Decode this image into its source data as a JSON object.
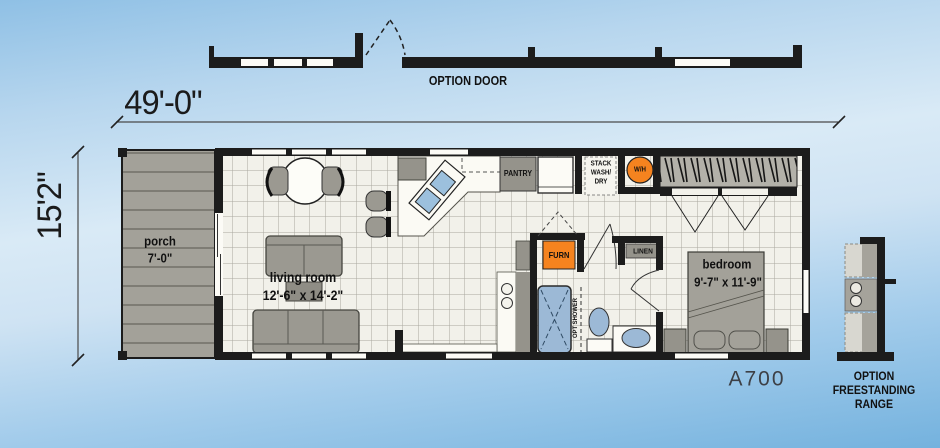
{
  "colors": {
    "wall": "#1c1c1c",
    "tile_floor": "#f2f1ea",
    "porch_deck": "#a3a199",
    "furniture_gray": "#9b9991",
    "cabinet_gray": "#95938b",
    "accent_orange": "#f5831f",
    "fixture_blue": "#9cb9d6",
    "sky_light": "#d9eaf6",
    "sky_dark": "#74b2de"
  },
  "top_elevation": {
    "option_door_label": "OPTION DOOR"
  },
  "dimensions": {
    "overall_width": "49'-0\"",
    "overall_height": "15'2\""
  },
  "rooms": {
    "porch": {
      "name": "porch",
      "size": "7'-0\""
    },
    "living_room": {
      "name": "living room",
      "size": "12'-6\" x 14'-2\""
    },
    "bedroom": {
      "name": "bedroom",
      "size": "9'-7\" x 11'-9\""
    }
  },
  "labels": {
    "pantry": "PANTRY",
    "stack_wash_dry": [
      "STACK",
      "WASH/",
      "DRY"
    ],
    "water_heater": "W/H",
    "furnace": "FURN",
    "linen": "LINEN",
    "opt_shower": "OPT SHOWER"
  },
  "model_number": "A700",
  "option_range_note": [
    "OPTION",
    "FREESTANDING",
    "RANGE"
  ]
}
